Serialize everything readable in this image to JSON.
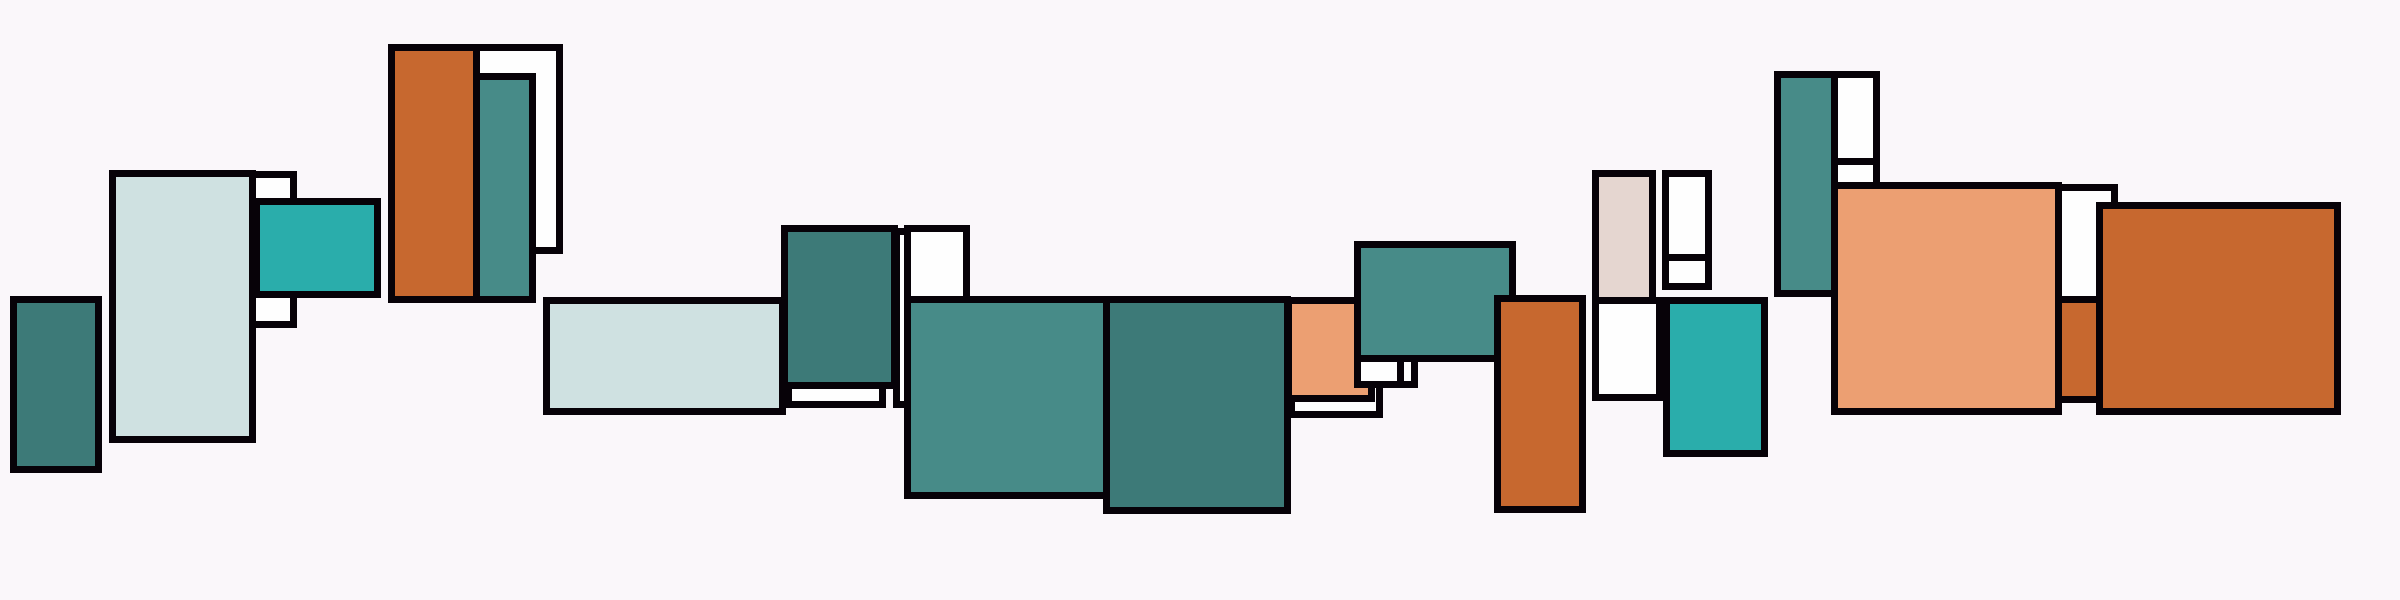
{
  "canvas": {
    "width": 2400,
    "height": 600,
    "background": "#FAF7FA",
    "border_color": "#070208",
    "border_width": 7
  },
  "palette": {
    "dark_teal": "#3D7A78",
    "teal": "#478B88",
    "turquoise": "#2AADAB",
    "pale": "#CFE1E1",
    "beige": "#E5D6D0",
    "salmon": "#EC9F72",
    "orange": "#C7682F",
    "white": "#FEFEFE"
  },
  "rects": [
    {
      "name": "white-backing-behind-pale-panel",
      "x": 245,
      "y": 171,
      "w": 52,
      "h": 157,
      "color": "white"
    },
    {
      "name": "pale-tall-panel",
      "x": 109,
      "y": 170,
      "w": 147,
      "h": 273,
      "color": "pale"
    },
    {
      "name": "turquoise-block-left",
      "x": 253,
      "y": 198,
      "w": 128,
      "h": 100,
      "color": "turquoise"
    },
    {
      "name": "dark-teal-block-far-left",
      "x": 10,
      "y": 296,
      "w": 92,
      "h": 177,
      "color": "dark_teal"
    },
    {
      "name": "white-panel-beside-orange",
      "x": 473,
      "y": 44,
      "w": 90,
      "h": 210,
      "color": "white"
    },
    {
      "name": "orange-tall-block-left",
      "x": 388,
      "y": 44,
      "w": 92,
      "h": 259,
      "color": "orange"
    },
    {
      "name": "teal-column-over-white",
      "x": 473,
      "y": 73,
      "w": 63,
      "h": 230,
      "color": "teal"
    },
    {
      "name": "pale-horizontal-bar",
      "x": 543,
      "y": 297,
      "w": 243,
      "h": 118,
      "color": "pale"
    },
    {
      "name": "white-offset-strip-below-teal",
      "x": 785,
      "y": 345,
      "w": 101,
      "h": 63,
      "color": "white"
    },
    {
      "name": "white-sliver-column",
      "x": 893,
      "y": 228,
      "w": 20,
      "h": 180,
      "color": "white"
    },
    {
      "name": "dark-teal-block-mid",
      "x": 781,
      "y": 225,
      "w": 117,
      "h": 164,
      "color": "dark_teal"
    },
    {
      "name": "white-small-box-above-teal",
      "x": 904,
      "y": 225,
      "w": 66,
      "h": 80,
      "color": "white"
    },
    {
      "name": "teal-large-block-center",
      "x": 904,
      "y": 296,
      "w": 206,
      "h": 203,
      "color": "teal"
    },
    {
      "name": "dark-teal-large-block-center",
      "x": 1103,
      "y": 296,
      "w": 188,
      "h": 218,
      "color": "dark_teal"
    },
    {
      "name": "white-offset-strip-below-salmon",
      "x": 1288,
      "y": 350,
      "w": 95,
      "h": 68,
      "color": "white"
    },
    {
      "name": "salmon-small-block",
      "x": 1285,
      "y": 297,
      "w": 90,
      "h": 105,
      "color": "salmon"
    },
    {
      "name": "white-chip-right",
      "x": 1397,
      "y": 352,
      "w": 21,
      "h": 36,
      "color": "white"
    },
    {
      "name": "white-chip-left",
      "x": 1354,
      "y": 350,
      "w": 50,
      "h": 38,
      "color": "white"
    },
    {
      "name": "teal-wide-block",
      "x": 1354,
      "y": 241,
      "w": 162,
      "h": 121,
      "color": "teal"
    },
    {
      "name": "orange-tall-block-mid",
      "x": 1494,
      "y": 295,
      "w": 92,
      "h": 218,
      "color": "orange"
    },
    {
      "name": "beige-column",
      "x": 1592,
      "y": 170,
      "w": 64,
      "h": 134,
      "color": "beige"
    },
    {
      "name": "white-box-below-beige",
      "x": 1592,
      "y": 297,
      "w": 71,
      "h": 104,
      "color": "white"
    },
    {
      "name": "white-stacked-lower",
      "x": 1662,
      "y": 253,
      "w": 50,
      "h": 37,
      "color": "white"
    },
    {
      "name": "white-stacked-upper",
      "x": 1662,
      "y": 170,
      "w": 50,
      "h": 91,
      "color": "white"
    },
    {
      "name": "turquoise-block-right",
      "x": 1663,
      "y": 297,
      "w": 105,
      "h": 160,
      "color": "turquoise"
    },
    {
      "name": "white-stacked-lower-far-right",
      "x": 1831,
      "y": 157,
      "w": 49,
      "h": 33,
      "color": "white"
    },
    {
      "name": "white-stacked-upper-far-right",
      "x": 1831,
      "y": 71,
      "w": 49,
      "h": 94,
      "color": "white"
    },
    {
      "name": "teal-column-far-right",
      "x": 1774,
      "y": 71,
      "w": 64,
      "h": 226,
      "color": "teal"
    },
    {
      "name": "orange-strip-behind-white",
      "x": 2055,
      "y": 296,
      "w": 48,
      "h": 107,
      "color": "orange"
    },
    {
      "name": "white-column-beside-salmon",
      "x": 2055,
      "y": 184,
      "w": 63,
      "h": 119,
      "color": "white"
    },
    {
      "name": "salmon-large-block",
      "x": 1831,
      "y": 182,
      "w": 231,
      "h": 233,
      "color": "salmon"
    },
    {
      "name": "orange-large-block",
      "x": 2096,
      "y": 202,
      "w": 245,
      "h": 213,
      "color": "orange"
    }
  ]
}
